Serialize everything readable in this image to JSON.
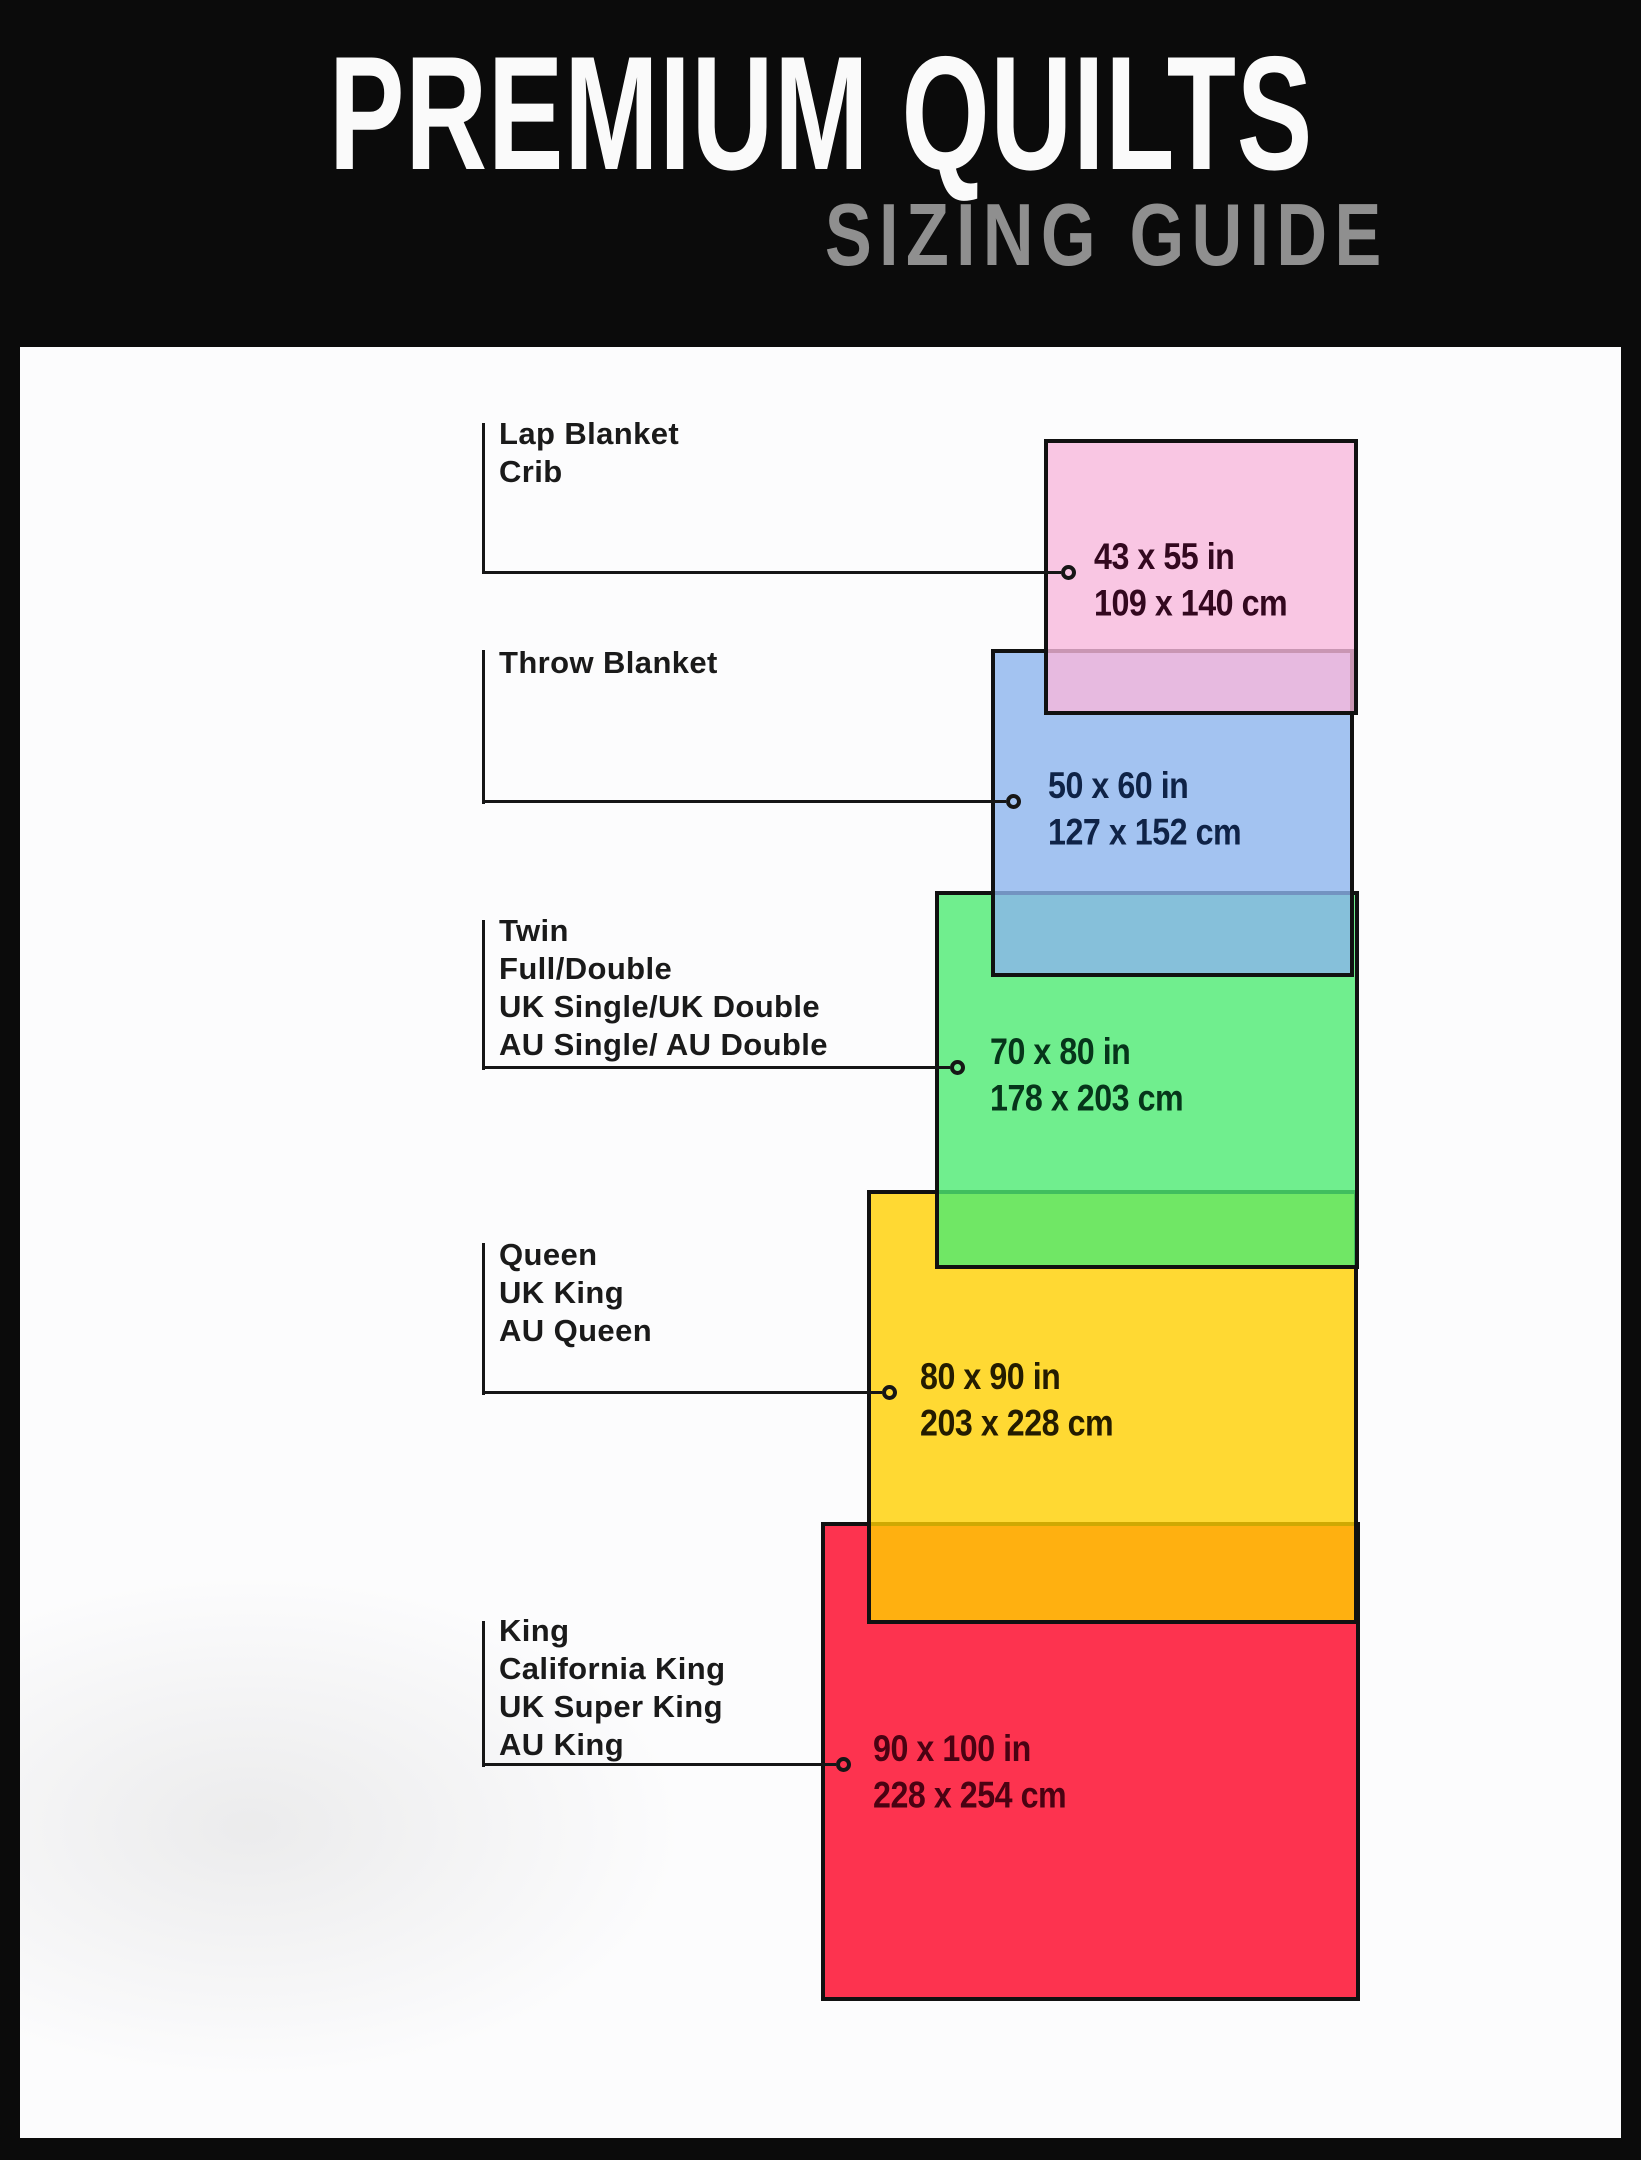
{
  "header": {
    "title": "PREMIUM QUILTS",
    "subtitle": "SIZING GUIDE"
  },
  "palette": {
    "background": "#0b0b0b",
    "panel": "#fcfcfd",
    "outline": "#111111",
    "subtitle_gray": "#8f8f8f",
    "observed_pink": "#f9c6e3",
    "observed_blue": "#a3c3f1",
    "observed_green": "#70ee8e",
    "observed_yellow": "#ffd903",
    "observed_red": "#fd2c4f",
    "overlap_pink_blue": "#e4aee7",
    "overlap_blue_green": "#66c3db",
    "overlap_green_yellow": "#6ce34e",
    "overlap_yellow_red": "#f8a704"
  },
  "sizes": [
    {
      "name": "lap-blanket-crib",
      "labels": "Lap Blanket\nCrib",
      "inches": "43 x 55 in",
      "cm": "109 x 140 cm",
      "fill": "#f7b8dc"
    },
    {
      "name": "throw-blanket",
      "labels": "Throw Blanket",
      "inches": "50 x 60 in",
      "cm": "127 x 152 cm",
      "fill": "#8cb4ed"
    },
    {
      "name": "twin-full-double",
      "labels": "Twin\nFull/Double\nUK Single/UK Double\nAU Single/ AU Double",
      "inches": "70 x 80 in",
      "cm": "178 x 203 cm",
      "fill": "#4cea72"
    },
    {
      "name": "queen-uk-king-au-queen",
      "labels": "Queen\nUK King\nAU Queen",
      "inches": "80 x 90 in",
      "cm": "203 x 228 cm",
      "fill": "#ffd000"
    },
    {
      "name": "king-california-king",
      "labels": "King\nCalifornia King\nUK Super King\nAU King",
      "inches": "90 x 100 in",
      "cm": "228 x 254 cm",
      "fill": "#fc0023"
    }
  ]
}
